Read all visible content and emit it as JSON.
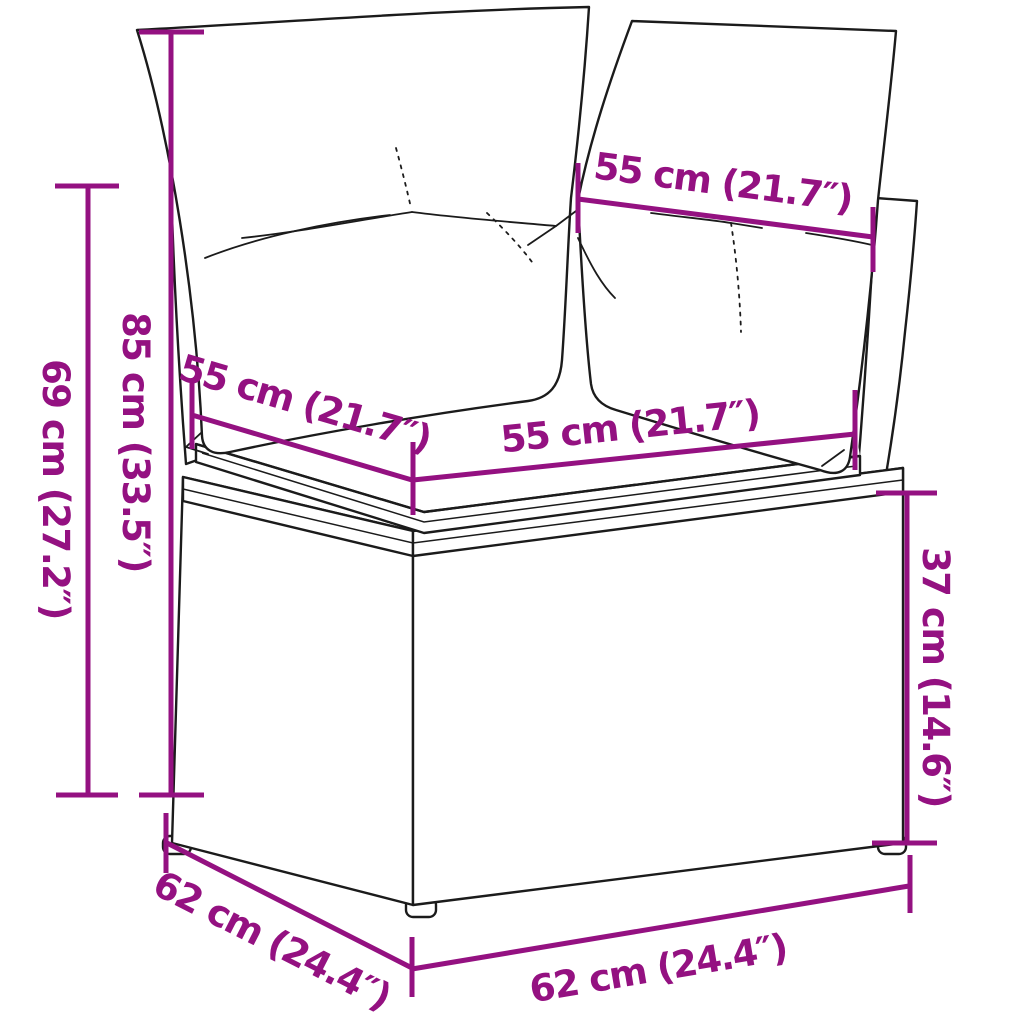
{
  "figure": {
    "type": "product-dimension-diagram",
    "product": "poly rattan corner sofa with cushions",
    "colors": {
      "dimension": "#941181",
      "outline": "#1b1b1b",
      "background": "#ffffff"
    },
    "dimensions": {
      "total_height": "85 cm (33.5″)",
      "backrest_height": "69 cm (27.2″)",
      "back_cushion_width": "55 cm (21.7″)",
      "seat_depth": "55 cm (21.7″)",
      "seat_width": "55 cm (21.7″)",
      "seat_height": "37 cm (14.6″)",
      "base_depth": "62 cm (24.4″)",
      "base_width": "62 cm (24.4″)"
    }
  }
}
